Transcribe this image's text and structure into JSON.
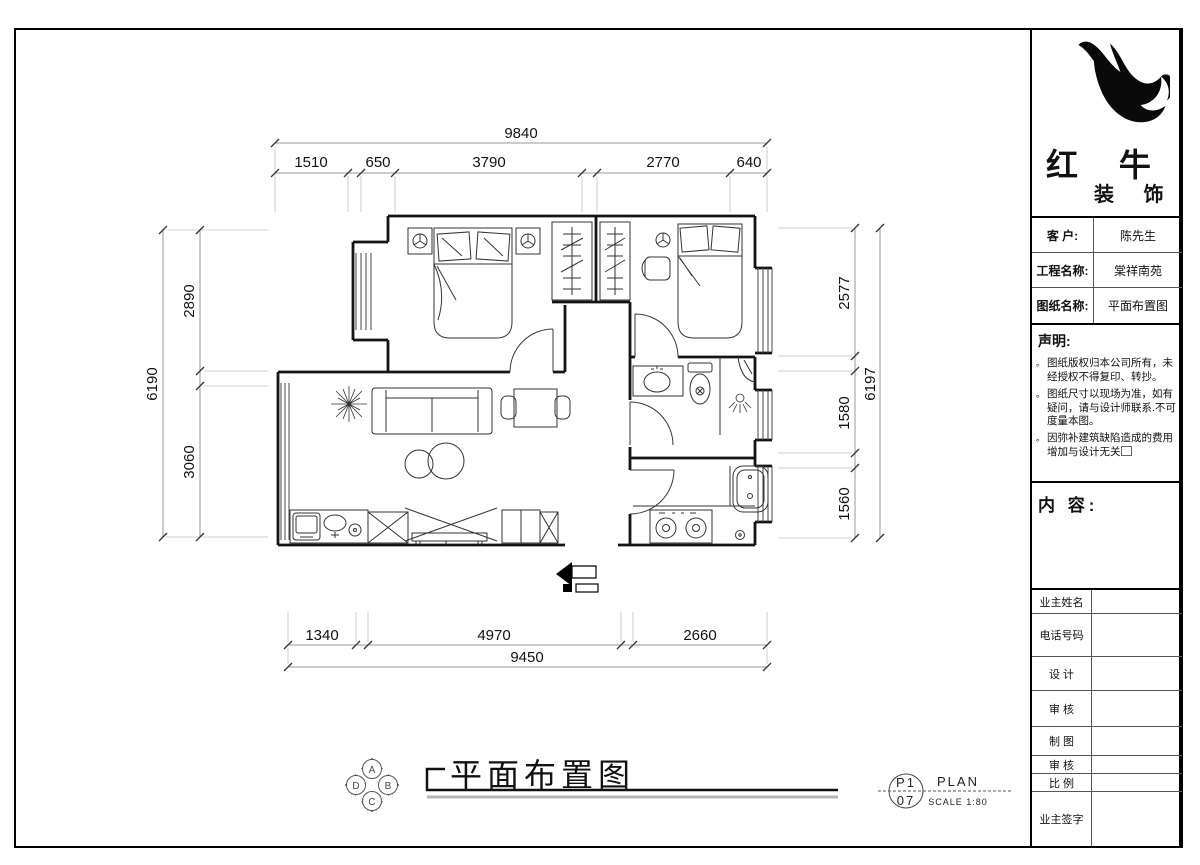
{
  "title_block": {
    "logo": {
      "icon": "redbull-bird-logo",
      "line1": "红 牛",
      "line2": "装 饰"
    },
    "info_rows": [
      {
        "label": "客  户:",
        "value": "陈先生"
      },
      {
        "label": "工程名称:",
        "value": "棠祥南苑"
      },
      {
        "label": "图纸名称:",
        "value": "平面布置图"
      }
    ],
    "statement": {
      "heading": "声明:",
      "items": [
        "图纸版权归本公司所有，未经授权不得复印、转抄。",
        "图纸尺寸以现场为准，如有疑问，请与设计师联系.不可度量本图。",
        "因弥补建筑缺陷造成的费用增加与设计无关"
      ]
    },
    "content_label": "内 容:",
    "field_rows": [
      {
        "label": "业主姓名"
      },
      {
        "label": "电话号码"
      },
      {
        "label": "设 计"
      },
      {
        "label": "审 核"
      },
      {
        "label": "制 图"
      },
      {
        "label": "审 核"
      },
      {
        "label": "比 例"
      },
      {
        "label": "业主签字"
      }
    ]
  },
  "drawing": {
    "caption": "平面布置图",
    "sheet": {
      "code_top": "P1",
      "code_bottom": "07",
      "name": "PLAN",
      "scale": "SCALE 1:80"
    },
    "orientation": {
      "top": "A",
      "right": "B",
      "bottom": "C",
      "left": "D"
    },
    "dimensions": {
      "top": {
        "overall": "9840",
        "segments": [
          "1510",
          "650",
          "3790",
          "2770",
          "640"
        ]
      },
      "bottom": {
        "overall": "9450",
        "segments": [
          "1340",
          "4970",
          "2660"
        ]
      },
      "left": {
        "overall": "6190",
        "segments": [
          "2890",
          "3060"
        ]
      },
      "right": {
        "overall": "6197",
        "segments": [
          "2577",
          "1580",
          "1560"
        ]
      }
    }
  }
}
